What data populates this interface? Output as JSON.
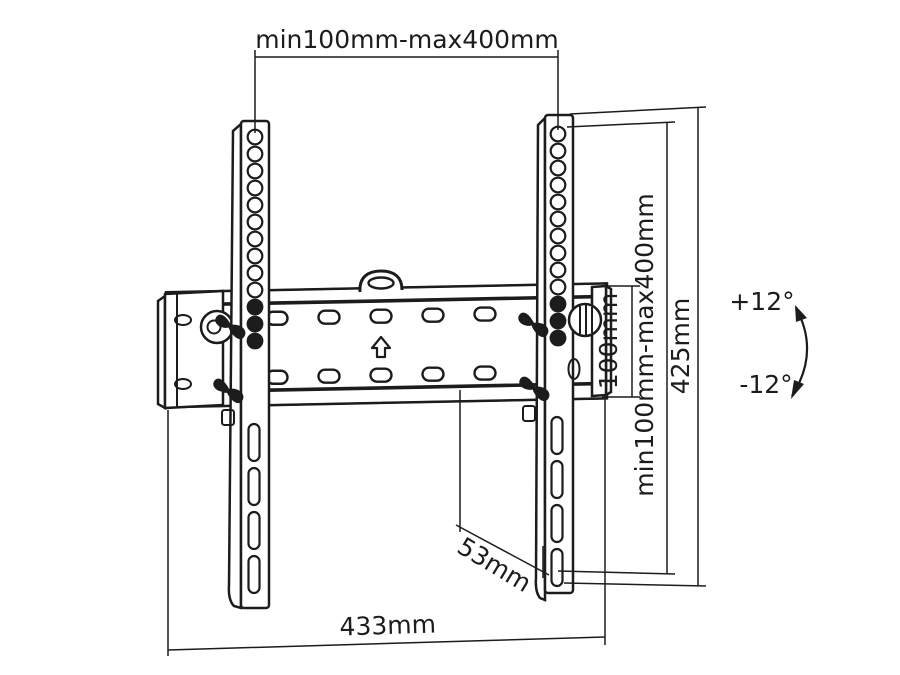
{
  "drawing": {
    "subject": "Tilting TV wall-mount bracket technical drawing",
    "line_color": "#1c1c1c",
    "background": "#ffffff"
  },
  "dimensions": {
    "top_span": "min100mm-max400mm",
    "vesa_vertical": "min100mm-max400mm",
    "bracket_height": "425mm",
    "plate_height": "100mm",
    "total_width": "433mm",
    "foot_depth": "53mm",
    "tilt_up": "+12°",
    "tilt_down": "-12°"
  }
}
